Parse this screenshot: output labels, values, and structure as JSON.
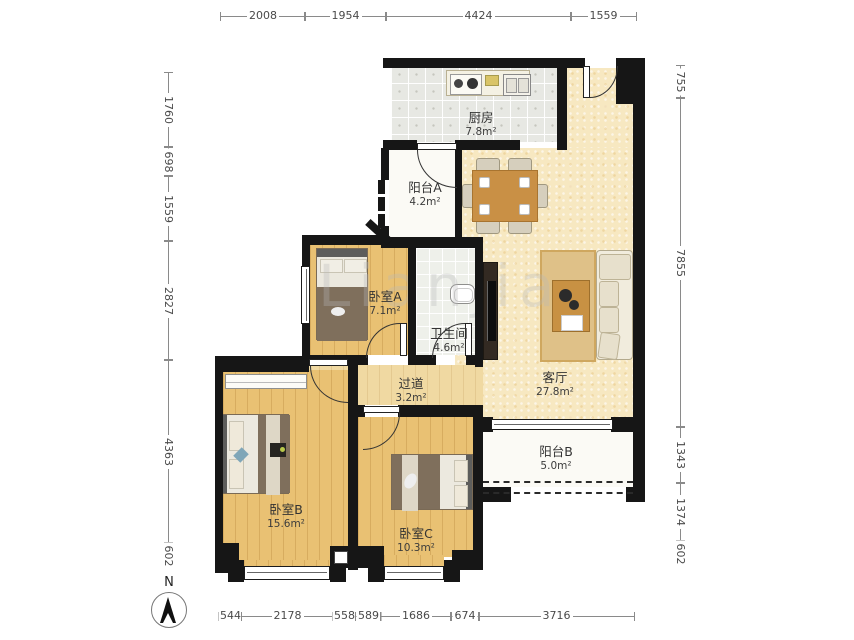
{
  "dimensions": {
    "top": [
      "2008",
      "1954",
      "4424",
      "1559"
    ],
    "bottom": [
      "544",
      "2178",
      "558",
      "589",
      "1686",
      "674",
      "3716"
    ],
    "left": [
      "1760",
      "698",
      "1559",
      "2827",
      "4363",
      "602"
    ],
    "right": [
      "755",
      "7855",
      "1343",
      "1374",
      "602"
    ]
  },
  "rooms": {
    "kitchen": {
      "name": "厨房",
      "area": "7.8m²"
    },
    "balcony_a": {
      "name": "阳台A",
      "area": "4.2m²"
    },
    "bedroom_a": {
      "name": "卧室A",
      "area": "7.1m²"
    },
    "bathroom": {
      "name": "卫生间",
      "area": "4.6m²"
    },
    "hallway": {
      "name": "过道",
      "area": "3.2m²"
    },
    "living_room": {
      "name": "客厅",
      "area": "27.8m²"
    },
    "balcony_b": {
      "name": "阳台B",
      "area": "5.0m²"
    },
    "bedroom_b": {
      "name": "卧室B",
      "area": "15.6m²"
    },
    "bedroom_c": {
      "name": "卧室C",
      "area": "10.3m²"
    }
  },
  "compass": {
    "label": "N"
  },
  "watermark": {
    "text": "Lianjia"
  },
  "colors": {
    "wall": "#161616",
    "wood_floor": "#e9c173",
    "living_floor": "#f7e8c1",
    "tile_floor": "#e7e8e3",
    "balcony_floor": "#fbfaf5",
    "dimension_text": "#4a4a4a",
    "label_text": "#333333"
  }
}
